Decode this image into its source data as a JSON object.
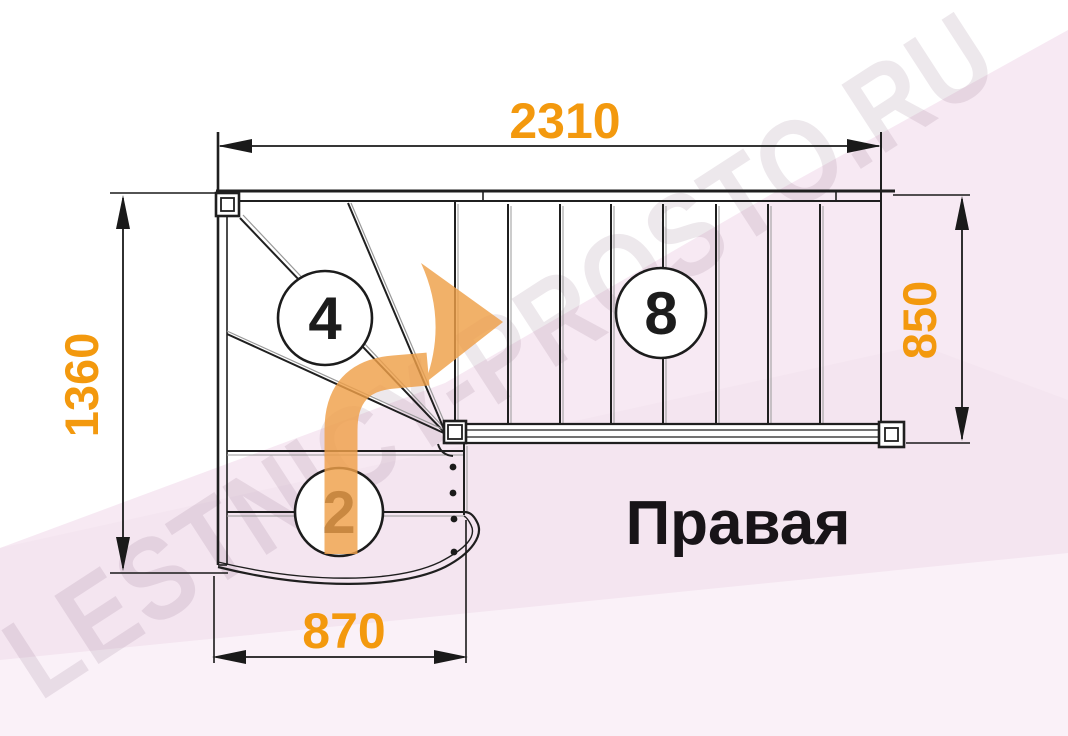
{
  "diagram": {
    "orientation_label": "Правая",
    "watermark": "LESTNICY-PROSTO.RU",
    "dimensions": {
      "top": "2310",
      "left": "1360",
      "right": "850",
      "bottom": "870"
    },
    "step_labels": {
      "winder_flight": "4",
      "lower_flight": "2",
      "upper_flight": "8"
    },
    "colors": {
      "dimension_text": "#F3990E",
      "arrow_fill": "#EFA049",
      "drawing_line": "#1F1F1F",
      "watermark_pink": "#F7E9F3"
    }
  }
}
